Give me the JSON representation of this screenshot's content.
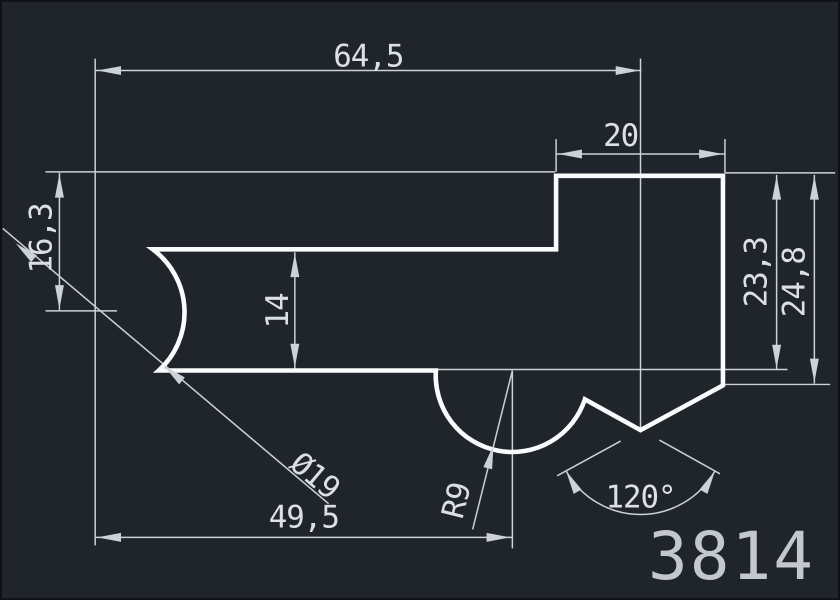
{
  "drawing": {
    "part_number": "3814",
    "canvas": {
      "width": 840,
      "height": 600
    },
    "colors": {
      "background": "#20252c",
      "border": "#0e1217",
      "outline": "#fafbfc",
      "dim": "#ccd2d6",
      "text": "#dbe0e4",
      "part_number": "#c3c8cd"
    },
    "stroke": {
      "outline_width": 4.6,
      "dim_width": 1.5,
      "arrow_length": 24,
      "arrow_half_width": 4.5,
      "dim_font_size": 31
    },
    "part": {
      "outline_path": "M 151 249 L 557 249 L 557 175 L 725 175 L 725 386 L 642 431 L 586 400 A 77 77 0 0 1 436 371 L 157 371 A 79 79 0 0 0 151 249 Z"
    },
    "dim_lines": [
      {
        "name": "ext-line-left-datum",
        "x1": 93,
        "y1": 57,
        "x2": 93,
        "y2": 547
      },
      {
        "name": "dim-64-5-line",
        "x1": 93,
        "y1": 69,
        "x2": 643,
        "y2": 69
      },
      {
        "name": "ext-line-notch-vertex",
        "x1": 642,
        "y1": 57,
        "x2": 642,
        "y2": 431
      },
      {
        "name": "ext-line-top-edge-left",
        "x1": 43,
        "y1": 171,
        "x2": 556,
        "y2": 171
      },
      {
        "name": "ext-line-circle-center",
        "x1": 43,
        "y1": 311,
        "x2": 115,
        "y2": 311
      },
      {
        "name": "dim-16-3-line",
        "x1": 57,
        "y1": 172,
        "x2": 57,
        "y2": 310
      },
      {
        "name": "dim-20-line",
        "x1": 557,
        "y1": 153,
        "x2": 727,
        "y2": 153
      },
      {
        "name": "ext-line-20-left",
        "x1": 557,
        "y1": 138,
        "x2": 557,
        "y2": 171
      },
      {
        "name": "ext-line-20-right",
        "x1": 727,
        "y1": 138,
        "x2": 727,
        "y2": 172
      },
      {
        "name": "ext-line-top-edge-right",
        "x1": 727,
        "y1": 172,
        "x2": 838,
        "y2": 172
      },
      {
        "name": "dim-23-3-line",
        "x1": 779,
        "y1": 174,
        "x2": 779,
        "y2": 370
      },
      {
        "name": "dim-24-8-line",
        "x1": 817,
        "y1": 174,
        "x2": 817,
        "y2": 384
      },
      {
        "name": "ext-line-bottom-edge",
        "x1": 436,
        "y1": 370,
        "x2": 790,
        "y2": 370
      },
      {
        "name": "ext-line-v-corner",
        "x1": 727,
        "y1": 385,
        "x2": 833,
        "y2": 385
      },
      {
        "name": "dim-49-5-line",
        "x1": 93,
        "y1": 539,
        "x2": 513,
        "y2": 539
      },
      {
        "name": "ext-line-arc-center",
        "x1": 513,
        "y1": 371,
        "x2": 513,
        "y2": 550
      },
      {
        "name": "leader-r9",
        "x1": 473,
        "y1": 531,
        "x2": 513,
        "y2": 371
      },
      {
        "name": "dim-dia19-line",
        "x1": 0,
        "y1": 228,
        "x2": 328,
        "y2": 505
      },
      {
        "name": "ext-line-angle-left",
        "x1": 622,
        "y1": 442,
        "x2": 558,
        "y2": 477
      },
      {
        "name": "ext-line-angle-right",
        "x1": 661,
        "y1": 441,
        "x2": 722,
        "y2": 475
      },
      {
        "name": "dim-14-line",
        "x1": 294,
        "y1": 252,
        "x2": 294,
        "y2": 369
      }
    ],
    "dim_arcs": [
      {
        "name": "dim-120-arc",
        "d": "M 717 472 A 86 86 0 0 1 567 472"
      }
    ],
    "arrows": [
      {
        "name": "dim-64-5-arrow-left",
        "x": 95,
        "y": 69,
        "angle": 180
      },
      {
        "name": "dim-64-5-arrow-right",
        "x": 641,
        "y": 69,
        "angle": 0
      },
      {
        "name": "dim-20-arrow-left",
        "x": 559,
        "y": 153,
        "angle": 180
      },
      {
        "name": "dim-20-arrow-right",
        "x": 725,
        "y": 153,
        "angle": 0
      },
      {
        "name": "dim-16-3-arrow-top",
        "x": 57,
        "y": 173,
        "angle": 270
      },
      {
        "name": "dim-16-3-arrow-bottom",
        "x": 57,
        "y": 309,
        "angle": 90
      },
      {
        "name": "dim-14-arrow-top",
        "x": 294,
        "y": 253,
        "angle": 270
      },
      {
        "name": "dim-14-arrow-bottom",
        "x": 294,
        "y": 368,
        "angle": 90
      },
      {
        "name": "dim-23-3-arrow-top",
        "x": 779,
        "y": 175,
        "angle": 270
      },
      {
        "name": "dim-23-3-arrow-bottom",
        "x": 779,
        "y": 369,
        "angle": 90
      },
      {
        "name": "dim-24-8-arrow-top",
        "x": 817,
        "y": 175,
        "angle": 270
      },
      {
        "name": "dim-24-8-arrow-bottom",
        "x": 817,
        "y": 383,
        "angle": 90
      },
      {
        "name": "dim-49-5-arrow-left",
        "x": 95,
        "y": 539,
        "angle": 180
      },
      {
        "name": "dim-49-5-arrow-right",
        "x": 511,
        "y": 539,
        "angle": 0
      },
      {
        "name": "dim-dia19-arrow-outer",
        "x": 13,
        "y": 243,
        "angle": 220
      },
      {
        "name": "dim-dia19-arrow-inner",
        "x": 162,
        "y": 366,
        "angle": 220
      },
      {
        "name": "leader-r9-arrow",
        "x": 494,
        "y": 446,
        "angle": 284
      },
      {
        "name": "dim-120-arrow-left",
        "x": 567,
        "y": 472,
        "angle": 241
      },
      {
        "name": "dim-120-arrow-right",
        "x": 717,
        "y": 472,
        "angle": 299
      }
    ],
    "labels": [
      {
        "name": "dim-64-5-label",
        "text": "64,5",
        "x": 368,
        "y": 55,
        "rotate": 0
      },
      {
        "name": "dim-20-label",
        "text": "20",
        "x": 622,
        "y": 135,
        "rotate": 0
      },
      {
        "name": "dim-16-3-label",
        "text": "16,3",
        "x": 39,
        "y": 238,
        "rotate": -90
      },
      {
        "name": "dim-14-label",
        "text": "14",
        "x": 277,
        "y": 311,
        "rotate": -90
      },
      {
        "name": "dim-23-3-label",
        "text": "23,3",
        "x": 759,
        "y": 272,
        "rotate": -90
      },
      {
        "name": "dim-24-8-label",
        "text": "24,8",
        "x": 797,
        "y": 282,
        "rotate": -90
      },
      {
        "name": "dim-dia19-label",
        "text": "Ø19",
        "x": 314,
        "y": 477,
        "rotate": 40
      },
      {
        "name": "dim-49-5-label",
        "text": "49,5",
        "x": 303,
        "y": 519,
        "rotate": 0
      },
      {
        "name": "leader-r9-label",
        "text": "R9",
        "x": 457,
        "y": 502,
        "rotate": -76
      },
      {
        "name": "dim-120-label",
        "text": "120°",
        "x": 642,
        "y": 499,
        "rotate": 0
      }
    ]
  }
}
